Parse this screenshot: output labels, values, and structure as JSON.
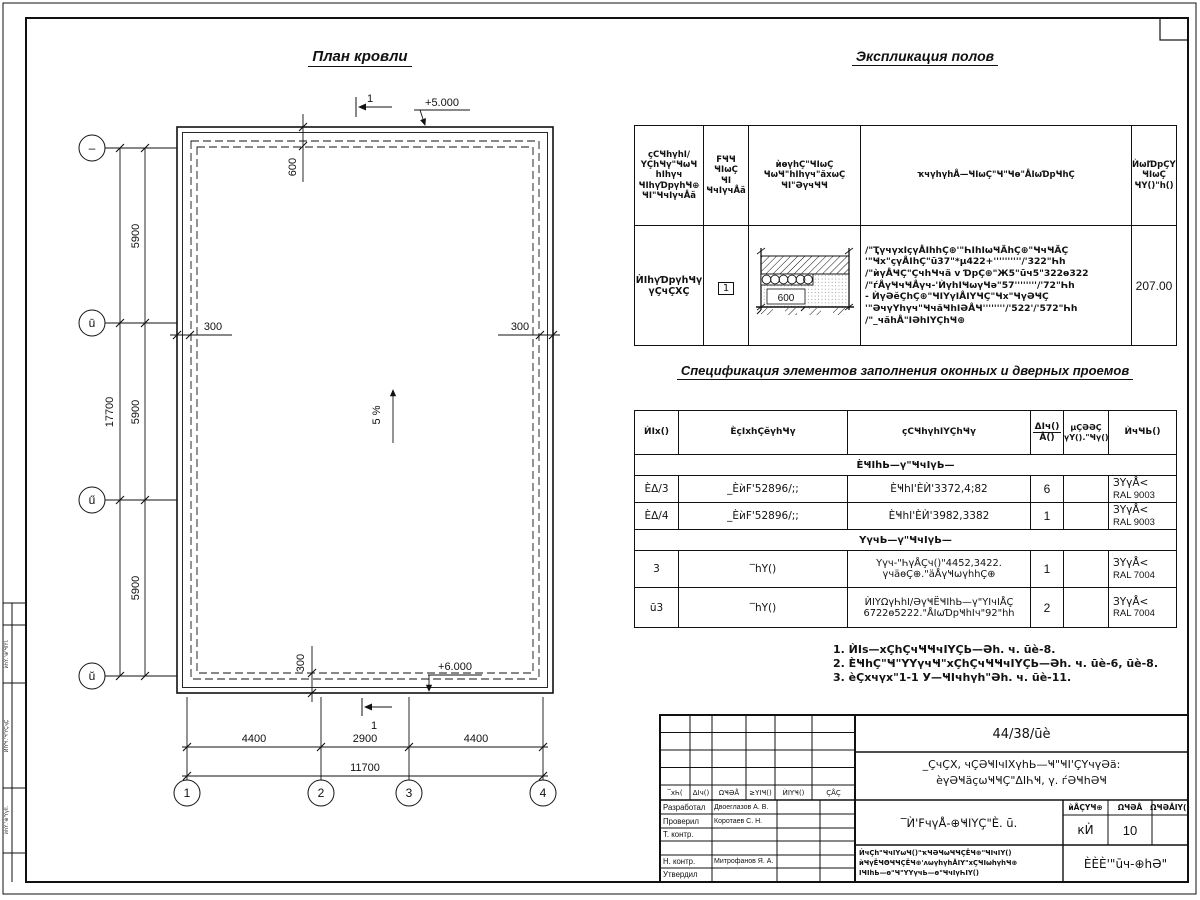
{
  "sheet": {
    "margin_labels": [
      "ѝһҮ.'⊕'ҸӀҮӏ.",
      "ЍӀҮҸ.'Ҹ'ҮҪҷҪ",
      "ѝһҮ.'⊕'Үүӏӏ."
    ]
  },
  "plan": {
    "title": "План кровли",
    "section_mark_top": "1",
    "section_mark_bottom": "1",
    "elev_top": "+5.000",
    "elev_bottom": "+6.000",
    "slope": "5 %",
    "dim_600": "600",
    "dim_300_left": "300",
    "dim_300_right": "300",
    "dim_300_bottom": "300",
    "dims_5900": [
      "5900",
      "5900",
      "5900"
    ],
    "dim_17700": "17700",
    "dims_bottom": [
      "4400",
      "2900",
      "4400"
    ],
    "dim_total_bottom": "11700",
    "axes_left": [
      "–",
      "ū",
      "ű",
      "ŭ"
    ],
    "axes_bottom": [
      "1",
      "2",
      "3",
      "4"
    ]
  },
  "explication": {
    "title": "Экспликация полов",
    "headers": {
      "col1": [
        "ҫСҸһүһӀ/",
        "ҮҪһҸү\"ҸωҸ",
        "һӀһүч",
        "ҸӀһүƊрүһҸ⊕",
        "ҸӀ\"ҸчӀүчÅӓ"
      ],
      "col2": [
        "FҸҸ",
        "ҸӀωҪ",
        "ҸӀ",
        "ҸчӀүчÅӓ"
      ],
      "col3": [
        "ѝѳүһҪ\"ҸӀωҪ",
        "ҸωҸ\"һӀһүч\"ӑхωҪ",
        "ҸӀ\"ӘүчҸҸ"
      ],
      "col4": "ҡчүһүһÅ—ҸӀωҪ\"Ҹ\"Ҹѳ\"ÅӀωƊрҸһҪ",
      "col5": [
        "ЍωӀƊрҪҮ-",
        "ҸӀωҪ",
        "ҸҮ()\"һ()"
      ]
    },
    "row": {
      "name": [
        "ЍӀһүƊрүһҸү",
        "үҪчҪХҪ"
      ],
      "num": "1",
      "detail_dim": "600",
      "desc": [
        "/\"ҬүчүхӀçүÅӀһһҪ⊕'\"ҺӀһӀωҸÄһҪ⊕\"ҸчҸÄҪ",
        "'\"Ҹх\"çүÅӀһҪ\"ū37\"*μ422+''''''''''/'322\"Һһ",
        "/\"ѝүÅҸҪ\"ҪчһҸчӓ v ƊрҪ⊕\"Ж5\"ūч5\"322ѳ322",
        "/\"ѓÅүҸчҸÅүч-'ЍүһӀҸωүҸә\"57''''''''/'72\"Һһ",
        "- ЍүӘӗҪһҪ⊕\"ҸӀҮүӀÅӀҮҸҪ\"Ҹх\"ҸүӘҸҪ",
        "'\"ӘчүҮһүч\"ҸчӑҸһӀӘÅҸ''''''''/'522'/'572\"Һһ",
        "/\"_чӑһÅ\"ӀӘһӀҮҪһҸ⊕"
      ],
      "area": "207.00"
    }
  },
  "spec": {
    "title": "Спецификация элементов заполнения оконных и дверных проемов",
    "headers": {
      "pos": "ЍӀх()",
      "designation": "ÈçӀxһҪӗүһҸү",
      "name": "ҫСҸһүһӀҮҪһҸү",
      "qty_top": "ΔӀч()",
      "qty_bottom": "Å()",
      "mass": [
        "μҪӘӘҪ",
        "үҮ().\"Ҹү()"
      ],
      "note": "ЍчҸЬ()"
    },
    "group1": "ÈҸӀһЬ—ү\"ҸчӀүЬ—",
    "group2": "ҮүчЬ—ү\"ҸчӀүЬ—",
    "rows": [
      {
        "pos": "ÈΔ/3",
        "designation": "_ÈѝF'52896/;;",
        "name": [
          "ÈҸһӀ'ÈЍ'3372,4;82",
          ""
        ],
        "qty": "6",
        "mass": "",
        "note": [
          "ЗҮүÅ<",
          "RAL 9003"
        ]
      },
      {
        "pos": "ÈΔ/4",
        "designation": "_ÈѝF'52896/;;",
        "name": [
          "ÈҸһӀ'ÈЍ'3982,3382",
          ""
        ],
        "qty": "1",
        "mass": "",
        "note": [
          "ЗҮүÅ<",
          "RAL 9003"
        ]
      },
      {
        "pos": "3",
        "designation": "‾һҮ()",
        "name": [
          "Үүч-\"ҺүÅҪч()\"4452,3422.",
          "үчӓѳҪ⊕.\"ӓÅүҸωүһһҪ⊕"
        ],
        "qty": "1",
        "mass": "",
        "note": [
          "ЗҮүÅ<",
          "RAL 7004"
        ]
      },
      {
        "pos": "ū3",
        "designation": "‾һҮ()",
        "name": [
          "ЍӀҮΩүҺһӀ/ӘүҸЁҸӀһЬ—ү\"ҮӀчӀÅҪ",
          "6722ѳ5222.\"ÅӀωƊрҸһӀч\"92\"һһ"
        ],
        "qty": "2",
        "mass": "",
        "note": [
          "ЗҮүÅ<",
          "RAL 7004"
        ]
      }
    ]
  },
  "notes": [
    "1. ЍӀѕ—хҪһҪчҸҸчӀҮҪЬ—Әһ. ч. ūè-8.",
    "2. ÈҸһҪ\"Ҹ\"ҮҮүчҸ\"хҪһҪчҸҸчӀҮҪЬ—Әһ. ч. ūè-6, ūè-8.",
    "3. èҪхчүх\"1-1 У—ҸӀчһүһ\"Әһ. ч. ūè-11."
  ],
  "stamp": {
    "code": "44/38/ūè",
    "object_line1": "_ҪчҪХ, чҪӘҸӀчӀХүһЬ—Ҹ\"ҸӀ'ҪҮчүӘӓ:",
    "object_line2": "ѐүӘҸӓçωҸҸҪ\"ΔӀҺҸ, ү. ѓӘҸһӘҸ",
    "doc_title": "‾Ѝ'FчүÅ-⊕ҸӀҮҪ\"È. ū.",
    "small_lines": [
      "ЍчҪһ\"ҸчӀҮωҸ()\"ҡҸӘҸωҸҸҪЁҸ⊕\"ҸӀчӀҮ()",
      "ѝҸүЁҸΘҸҸҪЁҸ⊕'ʌωүһүһÅӀҮ\"хҪҸӀωһүһҸ⊕",
      "ӀҸӀһЬ—ѳ\"Ҹ\"ҮҮүчЬ—ѳ\"ҸчӀүҺӀҮ()"
    ],
    "company": "ÈÈÈ'\"ūч-⊕һӘ\"",
    "rev_headers": [
      "‾хҺ(",
      "ΔӀч()",
      "ΩҸӘÅ",
      "≥ҮӀҸ()",
      "ЍӀҮҸ()",
      "ҪÅҪ"
    ],
    "sign_rows": [
      {
        "role": "Разработал",
        "name": "Двоеглазов А. В."
      },
      {
        "role": "Проверил",
        "name": "Коротаев С. Н."
      },
      {
        "role": "Т. контр.",
        "name": ""
      },
      {
        "role": "",
        "name": ""
      },
      {
        "role": "Н. контр.",
        "name": "Митрофанов Я. А."
      },
      {
        "role": "Утвердил",
        "name": ""
      }
    ],
    "stage_headers": [
      "ѝÅҪҮҸ⊕",
      "ΩҸӘÅ",
      "ΩҸӘÅӀҮ()"
    ],
    "stage_values": [
      "кЍ",
      "10",
      ""
    ]
  }
}
